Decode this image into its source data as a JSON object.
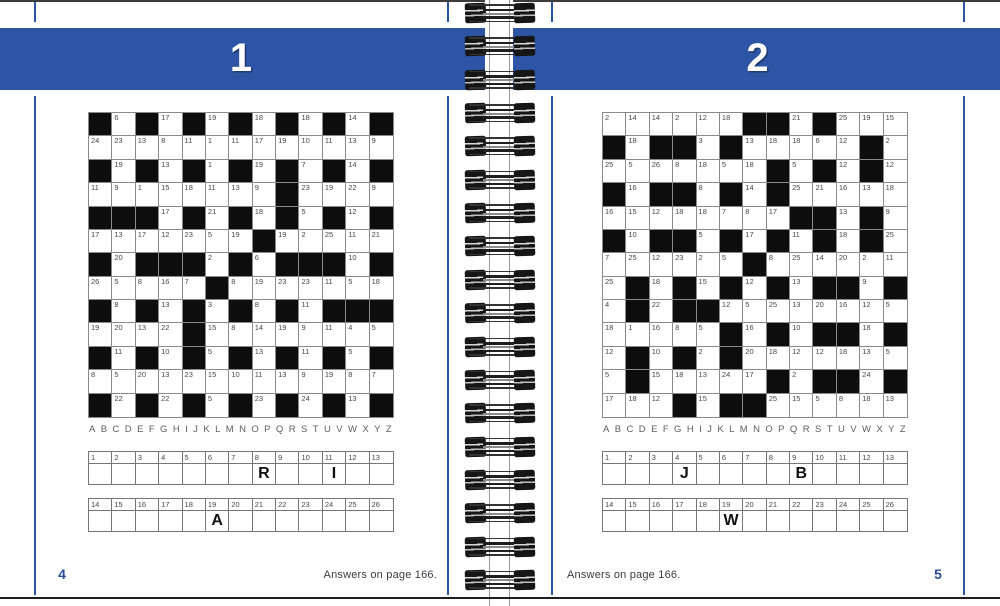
{
  "colors": {
    "blue": "#2e55a5",
    "black_cell": "#0d0d0d",
    "grid_border": "#8a8a8a",
    "page_number_blue": "#2a4d9b",
    "answers_text": "#3b3b44"
  },
  "spine": {
    "coil_count": 18
  },
  "pages": {
    "left": {
      "puzzle_number": "1",
      "page_number": "4",
      "answers_note": "Answers on page 166.",
      "alphabet": "ABCDEFGHIJKLMNOPQRSTUVWXYZ",
      "grid": [
        [
          "#",
          "6",
          "#",
          "17",
          "#",
          "19",
          "#",
          "18",
          "#",
          "18",
          "#",
          "14",
          "#"
        ],
        [
          "24",
          "23",
          "13",
          "8",
          "11",
          "1",
          "11",
          "17",
          "19",
          "10",
          "11",
          "13",
          "9"
        ],
        [
          "#",
          "19",
          "#",
          "13",
          "#",
          "1",
          "#",
          "19",
          "#",
          "7",
          "#",
          "14",
          "#"
        ],
        [
          "11",
          "9",
          "1",
          "15",
          "18",
          "11",
          "13",
          "9",
          "#",
          "23",
          "19",
          "22",
          "9"
        ],
        [
          "#",
          "#",
          "#",
          "17",
          "#",
          "21",
          "#",
          "18",
          "#",
          "5",
          "#",
          "12",
          "#"
        ],
        [
          "17",
          "13",
          "17",
          "12",
          "23",
          "5",
          "19",
          "#",
          "19",
          "2",
          "25",
          "11",
          "21"
        ],
        [
          "#",
          "20",
          "#",
          "#",
          "#",
          "2",
          "#",
          "6",
          "#",
          "#",
          "#",
          "10",
          "#"
        ],
        [
          "26",
          "5",
          "8",
          "16",
          "7",
          "#",
          "8",
          "19",
          "23",
          "23",
          "11",
          "5",
          "18"
        ],
        [
          "#",
          "8",
          "#",
          "13",
          "#",
          "3",
          "#",
          "8",
          "#",
          "11",
          "#",
          "#",
          "#"
        ],
        [
          "19",
          "20",
          "13",
          "22",
          "#",
          "15",
          "8",
          "14",
          "19",
          "9",
          "11",
          "4",
          "5"
        ],
        [
          "#",
          "11",
          "#",
          "10",
          "#",
          "5",
          "#",
          "13",
          "#",
          "11",
          "#",
          "5",
          "#"
        ],
        [
          "8",
          "5",
          "20",
          "13",
          "23",
          "15",
          "10",
          "11",
          "13",
          "9",
          "19",
          "8",
          "7"
        ],
        [
          "#",
          "22",
          "#",
          "22",
          "#",
          "5",
          "#",
          "23",
          "#",
          "24",
          "#",
          "13",
          "#"
        ]
      ],
      "strips": [
        {
          "numbers": [
            "1",
            "2",
            "3",
            "4",
            "5",
            "6",
            "7",
            "8",
            "9",
            "10",
            "11",
            "12",
            "13"
          ],
          "letters": [
            "",
            "",
            "",
            "",
            "",
            "",
            "",
            "R",
            "",
            "",
            "I",
            "",
            ""
          ]
        },
        {
          "numbers": [
            "14",
            "15",
            "16",
            "17",
            "18",
            "19",
            "20",
            "21",
            "22",
            "23",
            "24",
            "25",
            "26"
          ],
          "letters": [
            "",
            "",
            "",
            "",
            "",
            "A",
            "",
            "",
            "",
            "",
            "",
            "",
            ""
          ]
        }
      ]
    },
    "right": {
      "puzzle_number": "2",
      "page_number": "5",
      "answers_note": "Answers on page 166.",
      "alphabet": "ABCDEFGHIJKLMNOPQRSTUVWXYZ",
      "grid": [
        [
          "2",
          "14",
          "14",
          "2",
          "12",
          "18",
          "#",
          "#",
          "21",
          "#",
          "25",
          "19",
          "15"
        ],
        [
          "#",
          "18",
          "#",
          "#",
          "3",
          "#",
          "13",
          "18",
          "18",
          "6",
          "12",
          "#",
          "2"
        ],
        [
          "25",
          "5",
          "26",
          "8",
          "18",
          "5",
          "18",
          "#",
          "5",
          "#",
          "12",
          "#",
          "12"
        ],
        [
          "#",
          "16",
          "#",
          "#",
          "8",
          "#",
          "14",
          "#",
          "25",
          "21",
          "16",
          "13",
          "18"
        ],
        [
          "16",
          "15",
          "12",
          "18",
          "18",
          "7",
          "8",
          "17",
          "#",
          "#",
          "13",
          "#",
          "9"
        ],
        [
          "#",
          "10",
          "#",
          "#",
          "5",
          "#",
          "17",
          "#",
          "11",
          "#",
          "18",
          "#",
          "25"
        ],
        [
          "7",
          "25",
          "12",
          "23",
          "2",
          "5",
          "#",
          "8",
          "25",
          "14",
          "20",
          "2",
          "11"
        ],
        [
          "25",
          "#",
          "18",
          "#",
          "15",
          "#",
          "12",
          "#",
          "13",
          "#",
          "#",
          "9",
          "#"
        ],
        [
          "4",
          "#",
          "22",
          "#",
          "#",
          "12",
          "5",
          "25",
          "13",
          "20",
          "16",
          "12",
          "5"
        ],
        [
          "18",
          "1",
          "16",
          "8",
          "5",
          "#",
          "16",
          "#",
          "10",
          "#",
          "#",
          "18",
          "#"
        ],
        [
          "12",
          "#",
          "10",
          "#",
          "2",
          "#",
          "20",
          "18",
          "12",
          "12",
          "18",
          "13",
          "5"
        ],
        [
          "5",
          "#",
          "15",
          "18",
          "13",
          "24",
          "17",
          "#",
          "2",
          "#",
          "#",
          "24",
          "#"
        ],
        [
          "17",
          "18",
          "12",
          "#",
          "15",
          "#",
          "#",
          "25",
          "15",
          "5",
          "8",
          "18",
          "13"
        ]
      ],
      "strips": [
        {
          "numbers": [
            "1",
            "2",
            "3",
            "4",
            "5",
            "6",
            "7",
            "8",
            "9",
            "10",
            "11",
            "12",
            "13"
          ],
          "letters": [
            "",
            "",
            "",
            "J",
            "",
            "",
            "",
            "",
            "B",
            "",
            "",
            "",
            ""
          ]
        },
        {
          "numbers": [
            "14",
            "15",
            "16",
            "17",
            "18",
            "19",
            "20",
            "21",
            "22",
            "23",
            "24",
            "25",
            "26"
          ],
          "letters": [
            "",
            "",
            "",
            "",
            "",
            "W",
            "",
            "",
            "",
            "",
            "",
            "",
            ""
          ]
        }
      ]
    }
  }
}
